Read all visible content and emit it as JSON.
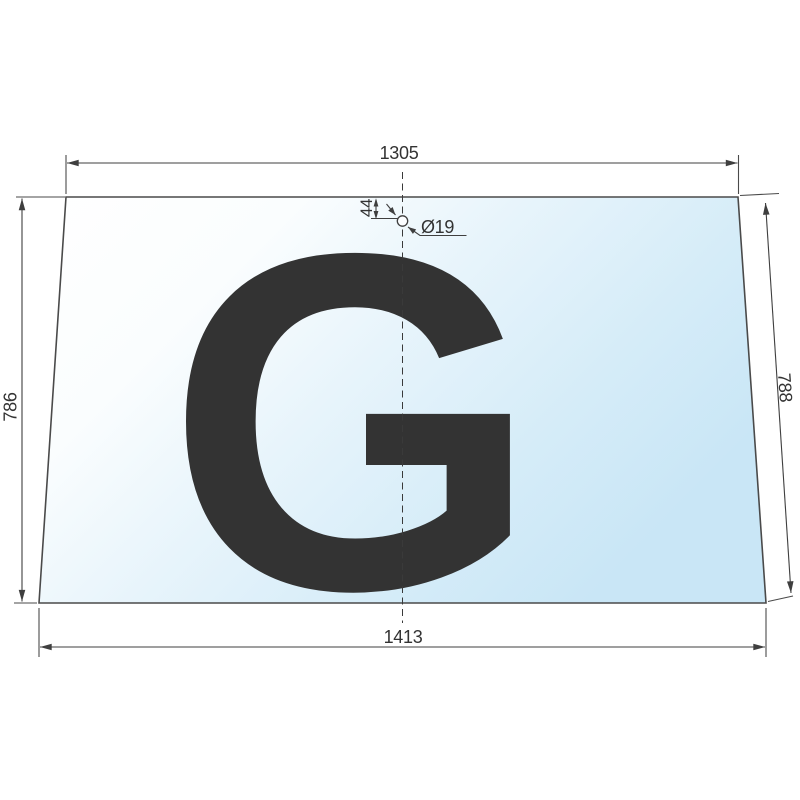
{
  "drawing": {
    "watermark_letter": "G",
    "dimensions": {
      "top_width": "1305",
      "bottom_width": "1413",
      "left_height": "786",
      "right_height": "788",
      "hole_offset_from_top": "44",
      "hole_diameter": "Ø19"
    },
    "colors": {
      "line": "#4a4a4a",
      "dim_line": "#3f3f3f",
      "text": "#333333",
      "glass_tint_light": "#ffffff",
      "glass_tint_blue": "#c9e6f6",
      "watermark": "#dde9f5",
      "hole_fill": "#fbfdff"
    }
  }
}
